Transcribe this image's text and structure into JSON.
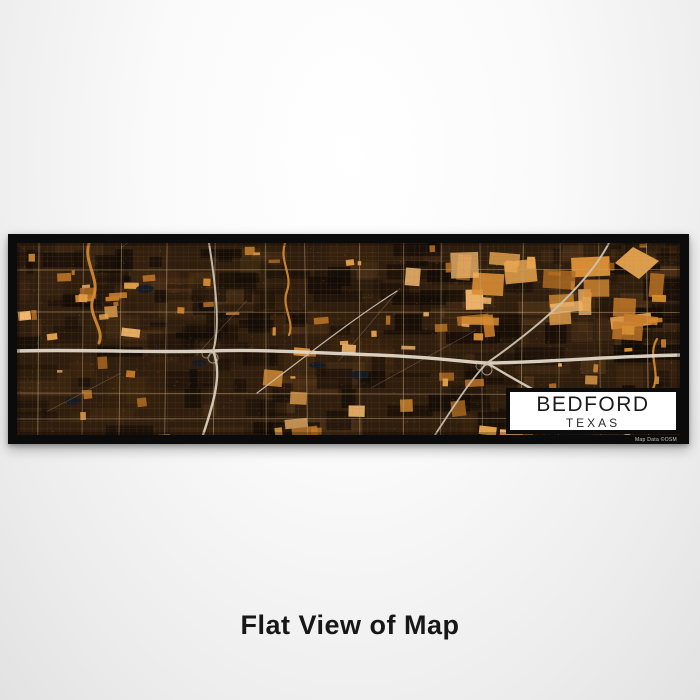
{
  "caption": {
    "text": "Flat View of Map"
  },
  "print": {
    "label": {
      "city": "BEDFORD",
      "state": "TEXAS"
    },
    "attribution": "Map Data ©OSM"
  },
  "map": {
    "style_name": "ember",
    "seed": 1337,
    "colors": {
      "base": "#2f1d0d",
      "dark": "#120b06",
      "mottle": [
        "#4f3318",
        "#5a3c1e",
        "#43290f",
        "#6a4522"
      ],
      "orange": [
        "#e8a44e",
        "#d88d33",
        "#c87b28",
        "#f1b66b",
        "#b26d22"
      ],
      "street": "#a07d54",
      "road": "#c3a378",
      "speckle": "#a8855a",
      "water": "#131b26",
      "river": "#d88d33"
    },
    "highways": [
      {
        "d": "M0,108 C60,106 140,110 196,108 C240,106 300,110 360,112 C420,114 455,120 470,120 C520,120 600,113 663,112",
        "w": 3.4,
        "c": "#e2d8c9"
      },
      {
        "d": "M196,108 C206,130 196,162 186,192",
        "w": 2.4,
        "c": "#d8cdbd"
      },
      {
        "d": "M196,108 C204,84 198,38 192,0",
        "w": 2.0,
        "c": "#cec2b0"
      },
      {
        "d": "M470,120 C520,150 562,172 612,192",
        "w": 2.4,
        "c": "#d8cdbd"
      },
      {
        "d": "M470,120 C530,78 572,38 592,0",
        "w": 2.0,
        "c": "#cec2b0"
      },
      {
        "d": "M418,192 C440,158 456,134 470,120",
        "w": 1.8,
        "c": "#cabfae"
      },
      {
        "d": "M240,150 C280,120 330,80 380,48",
        "w": 1.2,
        "c": "#b5a astray"
      }
    ],
    "rivers": [
      {
        "d": "M72,0 C66,20 84,36 76,55 C70,72 88,86 82,100",
        "w": 3.0
      },
      {
        "d": "M268,0 C262,18 276,32 270,48 C264,64 278,78 272,92",
        "w": 2.2
      },
      {
        "d": "M640,96 C630,112 644,128 636,146",
        "w": 2.2
      }
    ],
    "lakes": [
      [
        128,
        46,
        9,
        4
      ],
      [
        342,
        132,
        10,
        4
      ],
      [
        56,
        158,
        8,
        3.5
      ],
      [
        182,
        120,
        7,
        3
      ],
      [
        300,
        122,
        8,
        3
      ]
    ],
    "orange_zones": [
      {
        "x": 390,
        "y": 2,
        "w": 255,
        "h": 78,
        "n": 26,
        "min": 8,
        "max": 42
      },
      {
        "x": 2,
        "y": 2,
        "w": 659,
        "h": 188,
        "n": 58,
        "min": 3,
        "max": 16
      },
      {
        "x": 240,
        "y": 138,
        "w": 330,
        "h": 48,
        "n": 15,
        "min": 6,
        "max": 26
      },
      {
        "x": 28,
        "y": 40,
        "w": 130,
        "h": 72,
        "n": 11,
        "min": 5,
        "max": 20
      }
    ],
    "diamond_points": "616,4 642,18 622,36 598,20",
    "grid": {
      "v_step": 6.5,
      "h_step": 6.0,
      "major_v_step": 45,
      "major_h_ys": [
        27,
        69,
        150,
        176
      ]
    }
  }
}
